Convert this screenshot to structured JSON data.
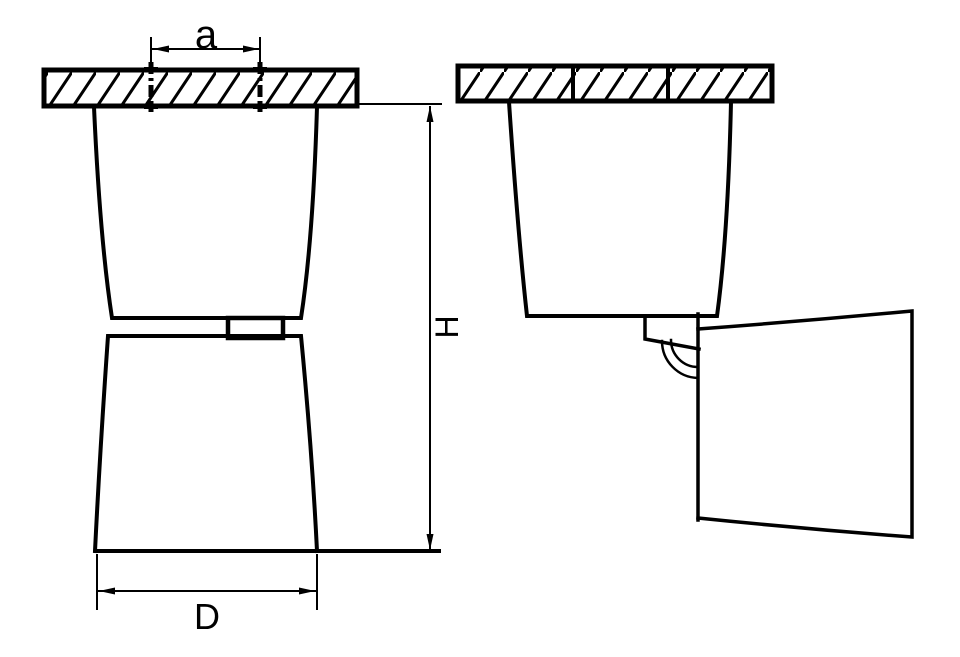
{
  "canvas": {
    "background": "#ffffff",
    "line_color": "#000000"
  },
  "dimensions": {
    "mount_spacing": {
      "label": "a"
    },
    "height": {
      "label": "H"
    },
    "diameter": {
      "label": "D"
    }
  }
}
